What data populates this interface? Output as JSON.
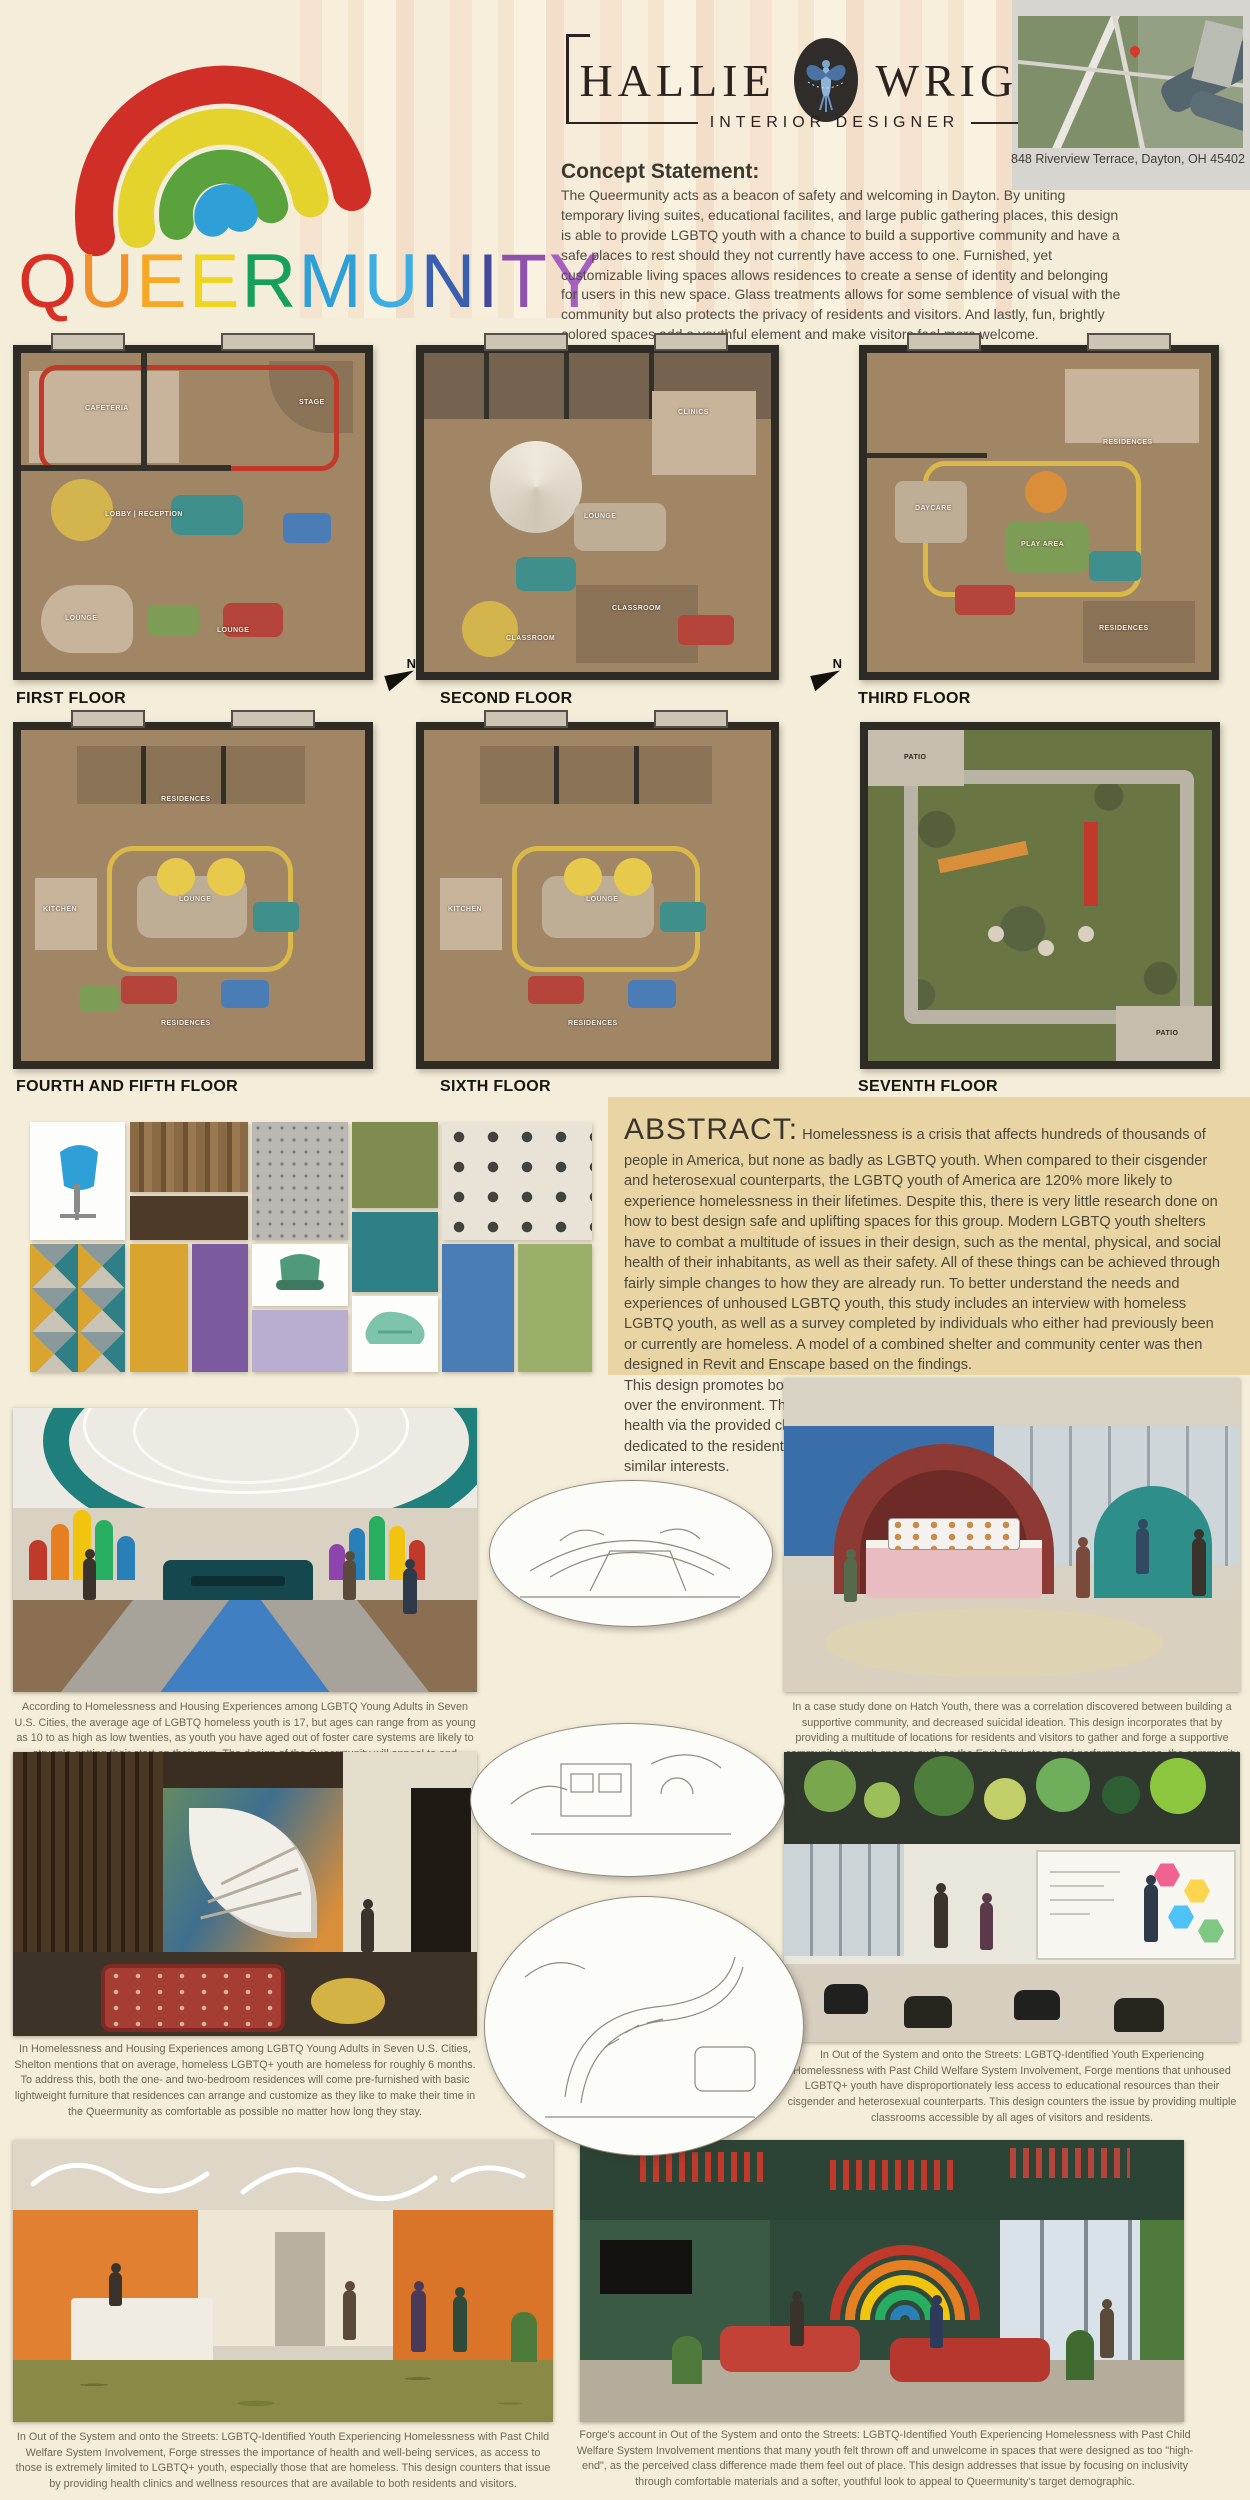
{
  "title": {
    "word": "QUEERMUNITY",
    "letters": [
      {
        "ch": "Q",
        "color": "#d93025"
      },
      {
        "ch": "U",
        "color": "#f0922b"
      },
      {
        "ch": "E",
        "color": "#f6a824"
      },
      {
        "ch": "E",
        "color": "#efd520"
      },
      {
        "ch": "R",
        "color": "#16a05a"
      },
      {
        "ch": "M",
        "color": "#2f9fd8"
      },
      {
        "ch": "U",
        "color": "#3dade2"
      },
      {
        "ch": "N",
        "color": "#3a5fae"
      },
      {
        "ch": "I",
        "color": "#44479c"
      },
      {
        "ch": "T",
        "color": "#8e51ae"
      },
      {
        "ch": "Y",
        "color": "#a45fc0"
      }
    ]
  },
  "brand": {
    "first": "HALLIE",
    "last": "WRIGHT",
    "subtitle": "INTERIOR DESIGNER",
    "logo_icon": "hummingbird-icon"
  },
  "address": "848 Riverview Terrace, Dayton, OH 45402",
  "concept": {
    "heading": "Concept Statement:",
    "body": "The Queermunity acts as a beacon of safety and  welcoming in Dayton. By uniting temporary living suites, educational facilites, and large public gathering places, this design is able to provide LGBTQ youth with a chance to build a supportive community and have a safe places to rest should they not currently have access to one. Furnished, yet customizable living spaces allows residences to create a sense of identity and belonging for users in this new space. Glass treatments allows for some semblence of visual with the community but also protects the privacy of residents and visitors. And lastly, fun, brightly colored spaces add a youthful element and make visitors feel more welcome."
  },
  "compass": {
    "label": "N"
  },
  "floors": [
    {
      "label": "FIRST FLOOR",
      "rooms": [
        "CAFETERIA",
        "STAGE",
        "LOBBY | RECEPTION",
        "LOUNGE",
        "LOUNGE"
      ]
    },
    {
      "label": "SECOND FLOOR",
      "rooms": [
        "CLINICS",
        "LOUNGE",
        "CLASSROOM",
        "CLASSROOM"
      ]
    },
    {
      "label": "THIRD FLOOR",
      "rooms": [
        "RESIDENCES",
        "DAYCARE",
        "PLAY AREA",
        "RESIDENCES"
      ]
    },
    {
      "label": "FOURTH AND FIFTH FLOOR",
      "rooms": [
        "RESIDENCES",
        "KITCHEN",
        "LOUNGE",
        "RESIDENCES"
      ]
    },
    {
      "label": "SIXTH FLOOR",
      "rooms": [
        "KITCHEN",
        "LOUNGE",
        "RESIDENCES"
      ]
    },
    {
      "label": "SEVENTH FLOOR",
      "rooms": [
        "PATIO",
        "PATIO"
      ]
    }
  ],
  "abstract": {
    "heading": "ABSTRACT:",
    "para1": "Homelessness is a crisis that affects hundreds of thousands of people in America, but none as badly as LGBTQ youth. When compared to their cisgender and heterosexual counterparts, the LGBTQ youth of America are 120% more likely to experience homelessness in their lifetimes. Despite this, there is very little research done on how to best design safe and uplifting spaces for this group. Modern LGBTQ youth shelters have to combat a multitude of issues in their design, such as the mental, physical, and social health of their inhabitants, as well as their safety. All of these things can be achieved through fairly simple changes to how they are already run. To better understand the needs and experiences of unhoused LGBTQ youth, this study includes an interview with homeless LGBTQ youth, as well as a survey completed by individuals who either had previously been or currently are homeless. A model of a combined shelter and community center was then designed in Revit and Enscape based on the findings.",
    "para2": "This design  promotes both a sense of community and safety, and well as comfort and control over the environment. Three of the seven floors are dedicated to community building and health via the provided clinics, classrooms, and lounge spaces. The remaining four floors are dedicated to the residents, offering private rooms grouped into neighborhoods based on similar interests."
  },
  "captions": [
    "According to Homelessness and Housing Experiences among LGBTQ Young Adults in Seven U.S. Cities, the average age of LGBTQ homeless youth is 17, but ages can range from as young as 10 to as high as low twenties, as youth you have aged out of foster care systems are likely to struggle getting their start on their own. The design of the Queermunity will appeal to and accomodate that range of ages through a design that is bright and playful but not childlike.",
    "In a case study done on Hatch Youth, there was a correlation discovered between building a supportive community, and decreased suicidal ideation. This design incorporates that by providing a multitude of locations for residents and visitors to gather and forge a supportive community through spaces such as the Fruit Bowl stage and performance area, the community and event rooms on the 1st and 7th floor, and through residences grouped by pre-determined themes, allowing incoming youth to befriend their neighbors who have similar interests.",
    "In Homelessness and Housing Experiences among LGBTQ Young Adults in Seven U.S. Cities, Shelton mentions that on average, homeless LGBTQ+ youth are homeless for roughly 6 months. To address this, both the one- and two-bedroom residences will come pre-furnished with basic lightweight furniture that residences can arrange and customize as they like to make their time in the Queermunity as comfortable as possible no matter how long they stay.",
    "In Out of the System and onto the Streets: LGBTQ-Identified Youth Experiencing Homelessness with Past Child Welfare System Involvement, Forge mentions that unhoused LGBTQ+ youth have disproportionately less access to educational resources than their cisgender and heterosexual counterparts. This design counters the issue by providing multiple classrooms accessible by all ages of visitors and residents.",
    "In Out of the System and onto the Streets: LGBTQ-Identified Youth Experiencing Homelessness with Past Child Welfare System Involvement, Forge stresses the importance of health and well-being services, as access to those is extremely limited to LGBTQ+ youth, especially those that are homeless. This design counters that issue by providing health clinics and wellness resources that are available to both residents and visitors.",
    "Forge's account in Out of the System and onto the Streets: LGBTQ-Identified Youth Experiencing Homelessness with Past Child Welfare System Involvement mentions that many youth felt thrown off and unwelcome in spaces that were designed as too \"high-end\", as the perceived class difference made them feel out of place. This design addresses that issue by focusing on inclusivity through comfortable materials and a softer, youthful look to appeal to Queermunity's target demographic."
  ],
  "palette": {
    "poster_bg": "#f3edda",
    "abstract_bg": "#e9d5a4",
    "plan_wall": "#2e2b25",
    "plan_floor": "#a18666",
    "accent_teal": "#1f7f7d",
    "accent_red": "#c0392b",
    "accent_yellow": "#d9b94a",
    "accent_blue": "#3f7fc2"
  }
}
